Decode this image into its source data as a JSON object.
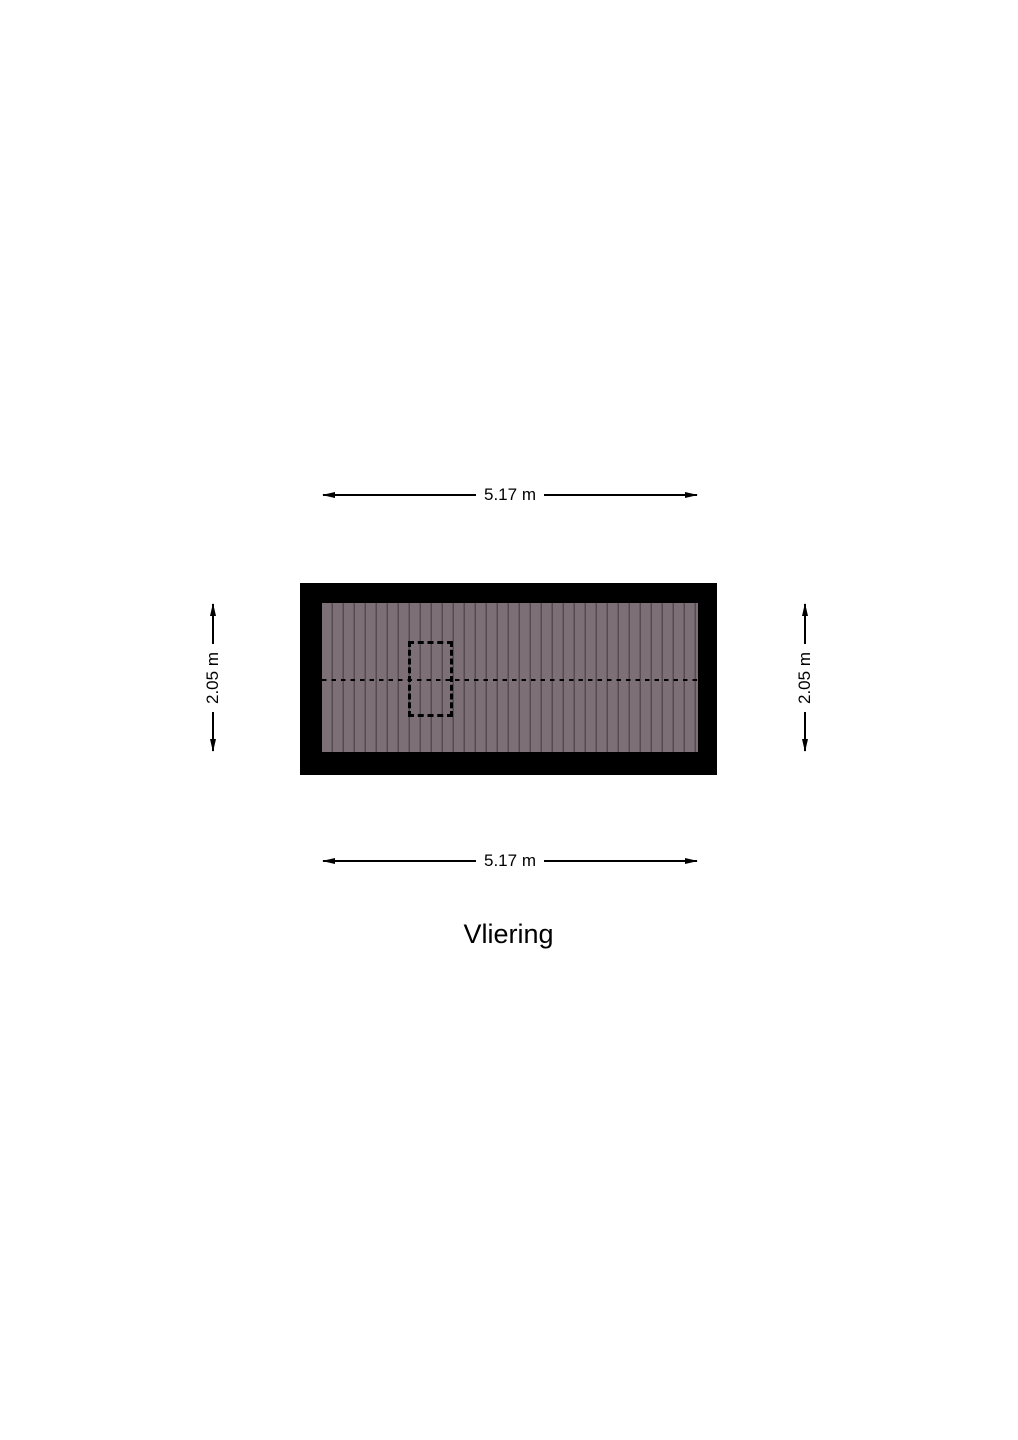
{
  "page": {
    "background_color": "#ffffff"
  },
  "floorplan": {
    "room_name": "Vliering",
    "wall_color": "#000000",
    "floor_color": "#7c6f76",
    "plank_line_color": "#564b51",
    "hatch_opening": {
      "outline_style": "dashed",
      "color": "#000000"
    },
    "ridge_line": {
      "style": "dashed",
      "color": "#000000"
    }
  },
  "dimensions": {
    "top": "5.17 m",
    "bottom": "5.17 m",
    "left": "2.05 m",
    "right": "2.05 m"
  },
  "title": "Vliering"
}
